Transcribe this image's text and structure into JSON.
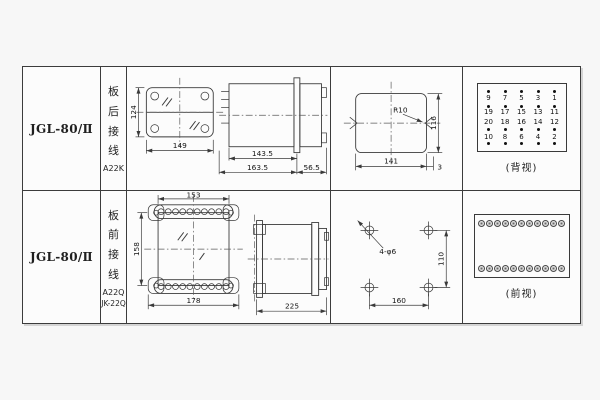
{
  "colors": {
    "page_bg": "#f7f7f7",
    "cell_bg": "#fcfcfc",
    "line": "#3a3a3a",
    "text": "#1a1a1a"
  },
  "rows": [
    {
      "model": "JGL-80/Ⅱ",
      "wiring": {
        "label": "板后接线",
        "codes": [
          "A22K"
        ]
      },
      "drawings": {
        "front": {
          "height": "124",
          "width": "149"
        },
        "side": {
          "body_depth": "143.5",
          "total_depth": "163.5",
          "front_depth": "56.5"
        },
        "cutout": {
          "radius": "R10",
          "width": "141",
          "height": "116",
          "edge_gap": "3"
        }
      },
      "terminals": {
        "caption": "(背视)",
        "grid": [
          [
            "9",
            "7",
            "5",
            "3",
            "1"
          ],
          [
            "19",
            "17",
            "15",
            "13",
            "11"
          ],
          [
            "20",
            "18",
            "16",
            "14",
            "12"
          ],
          [
            "10",
            "8",
            "6",
            "4",
            "2"
          ]
        ]
      }
    },
    {
      "model": "JGL-80/Ⅱ",
      "wiring": {
        "label": "板前接线",
        "codes": [
          "A22Q",
          "JK-22Q"
        ]
      },
      "drawings": {
        "front": {
          "top_width": "153",
          "height": "158",
          "bottom_width": "178"
        },
        "side": {
          "total_depth": "225"
        },
        "drill": {
          "holes_label": "4-φ6",
          "h_pitch": "160",
          "v_pitch": "110"
        }
      },
      "terminals": {
        "caption": "(前视)",
        "screws_per_row": 11,
        "rows": 2
      }
    }
  ]
}
